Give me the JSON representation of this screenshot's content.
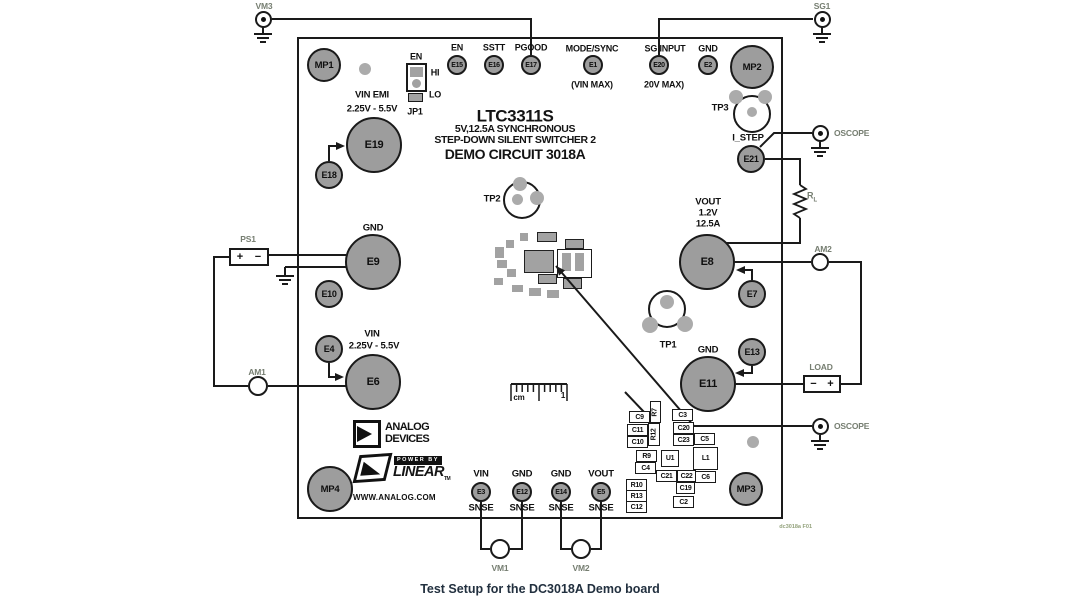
{
  "colors": {
    "pad": "#9d9d9d",
    "wire": "#1a1a1a",
    "dot": "#ababab",
    "board_label": "#101010",
    "external_label": "#767e71",
    "caption": "#22303f",
    "footer": "#93a27c"
  },
  "title_block": {
    "line1": "LTC3311S",
    "line2": "5V,12.5A SYNCHRONOUS",
    "line3": "STEP-DOWN SILENT SWITCHER 2",
    "line4": "DEMO CIRCUIT 3018A"
  },
  "caption": "Test Setup for the DC3018A Demo board",
  "footer_code": "dc3018a F01",
  "logo": {
    "analog": "ANALOG",
    "devices": "DEVICES",
    "power_by": "POWER BY",
    "linear": "LINEAR",
    "tm": "TM",
    "url": "WWW.ANALOG.COM"
  },
  "jumper": {
    "en": "EN",
    "hi": "HI",
    "lo": "LO",
    "name": "JP1"
  },
  "ps1": {
    "name": "PS1",
    "left": "+",
    "right": "−"
  },
  "load": {
    "name": "LOAD",
    "left": "−",
    "right": "+"
  },
  "rl": {
    "base": "R",
    "sub": "L"
  },
  "ruler": {
    "unit": "cm",
    "mark": "1"
  },
  "pad_refs": [
    "E15",
    "E16",
    "E17",
    "E1",
    "E20",
    "E2",
    "E3",
    "E12",
    "E14",
    "E5",
    "E18",
    "E10",
    "E4",
    "E21",
    "E7",
    "E13",
    "E19",
    "E9",
    "E6",
    "E8",
    "E11"
  ],
  "mount_refs": [
    "MP1",
    "MP2",
    "MP3",
    "MP4"
  ],
  "tp_refs": [
    "TP1",
    "TP2",
    "TP3"
  ],
  "component_refs": [
    "C9",
    "R7",
    "C3",
    "C11",
    "R12",
    "C20",
    "C10",
    "C23",
    "C5",
    "R9",
    "U1",
    "L1",
    "C4",
    "C21",
    "C22",
    "C6",
    "R10",
    "C19",
    "R13",
    "C2",
    "C12"
  ],
  "board_labels": {
    "en_header": "EN",
    "sstt_header": "SSTT",
    "pgood_header": "PGOOD",
    "mode_sync": "MODE/SYNC",
    "vin_max": "(VIN MAX)",
    "sg_input": "SG INPUT",
    "sg_max": "20V MAX)",
    "gnd_top": "GND",
    "vin_emi": "VIN EMI",
    "vin_emi_range": "2.25V - 5.5V",
    "gnd_e9": "GND",
    "vin_e6": "VIN",
    "vin_range": "2.25V - 5.5V",
    "vout": "VOUT",
    "vout_v": "1.2V",
    "vout_a": "12.5A",
    "gnd_e11": "GND",
    "vin_snse": "VIN",
    "gnd_snse_a": "GND",
    "gnd_snse_b": "GND",
    "vout_snse": "VOUT",
    "snse": "SNSE",
    "i_step": "I_STEP"
  },
  "external_labels": {
    "vm3": "VM3",
    "sg1": "SG1",
    "oscope": "OSCOPE",
    "am1": "AM1",
    "am2": "AM2",
    "vm1": "VM1",
    "vm2": "VM2"
  }
}
